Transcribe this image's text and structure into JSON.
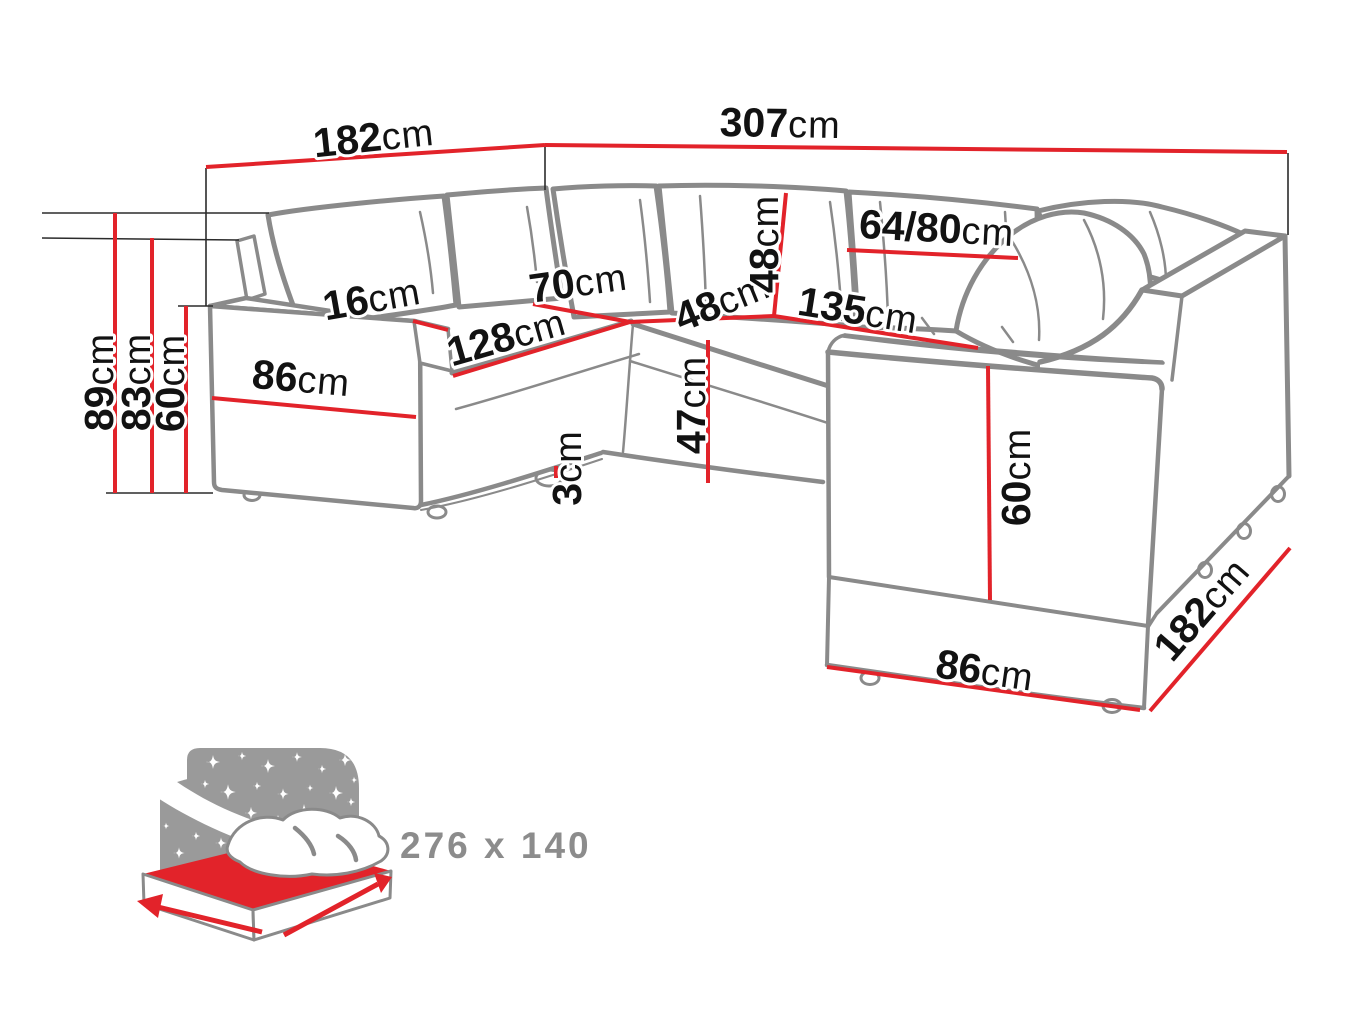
{
  "canvas": {
    "width": 1370,
    "height": 1027,
    "background": "#ffffff"
  },
  "colors": {
    "dimension_red": "#e2232a",
    "sofa_line_gray": "#8a8a8a",
    "label_black": "#121212",
    "icon_gray": "#9a9a9a",
    "icon_text_gray": "#8c8c8c"
  },
  "icons": {
    "sleeping_area": "bed-sleeping-area-icon"
  },
  "dimensions": {
    "top_left_width": {
      "value": "182",
      "unit": "cm"
    },
    "top_total_width": {
      "value": "307",
      "unit": "cm"
    },
    "total_height": {
      "value": "89",
      "unit": "cm"
    },
    "backrest_top_height": {
      "value": "83",
      "unit": "cm"
    },
    "armrest_height": {
      "value": "60",
      "unit": "cm"
    },
    "left_arm_depth": {
      "value": "86",
      "unit": "cm"
    },
    "armrest_width": {
      "value": "16",
      "unit": "cm"
    },
    "left_seat_depth": {
      "value": "70",
      "unit": "cm"
    },
    "left_seat_width": {
      "value": "128",
      "unit": "cm"
    },
    "back_cushion_height": {
      "value": "48",
      "unit": "cm"
    },
    "corner_seat_width": {
      "value": "48",
      "unit": "cm"
    },
    "seat_height": {
      "value": "47",
      "unit": "cm"
    },
    "leg_height": {
      "value": "3",
      "unit": "cm"
    },
    "right_seat_width": {
      "value": "135",
      "unit": "cm"
    },
    "pillow_width": {
      "value": "64/80",
      "unit": "cm"
    },
    "ottoman_height": {
      "value": "60",
      "unit": "cm"
    },
    "ottoman_front_width": {
      "value": "86",
      "unit": "cm"
    },
    "right_side_depth": {
      "value": "182",
      "unit": "cm"
    }
  },
  "sleeping_area": {
    "label": "276 x 140"
  }
}
